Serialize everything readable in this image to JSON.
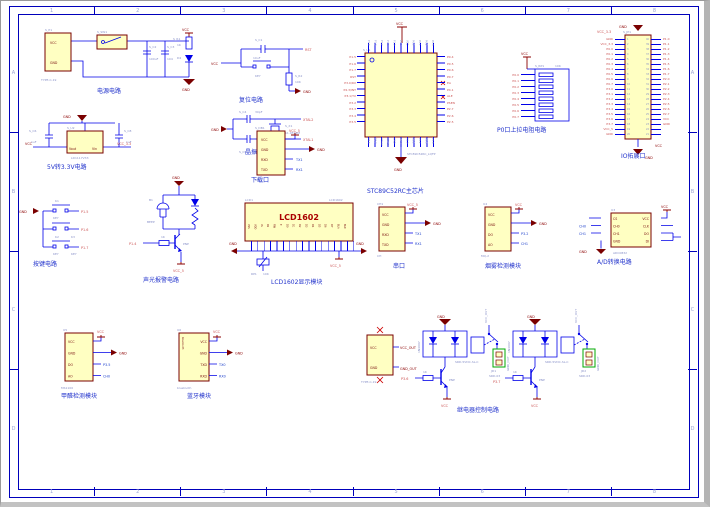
{
  "sheet": {
    "zones_h": [
      "1",
      "2",
      "3",
      "4",
      "5",
      "6",
      "7",
      "8"
    ],
    "zones_v": [
      "A",
      "B",
      "C",
      "D"
    ]
  },
  "colors": {
    "wire": "#0000E8",
    "frame": "#0000BB",
    "component_outline": "#7A0000",
    "component_fill": "#FFFFC2",
    "net_red": "#CC5555",
    "power_red": "#8B0000",
    "designator_blue": "#8890C8",
    "caption_blue": "#2233CC",
    "terminal_green": "#00AA00"
  },
  "blocks": {
    "power": {
      "label": "电源电路",
      "designator": "S_P1",
      "part": "TYPE-C-19",
      "pin1": "VCC",
      "pin2": "GND",
      "switch_des": "S_SW1",
      "cap1_des": "S_C2",
      "cap1_val": "100uF",
      "cap2_des": "S_C3",
      "cap2_val": "104",
      "res_des": "S_R1",
      "res_val": "1K",
      "led_des": "D4",
      "net_vcc": "VCC",
      "net_gnd": "GND"
    },
    "reset": {
      "label": "复位电路",
      "cap_des": "S_C1",
      "cap_val": "10uF",
      "key_part": "KEY",
      "res_des": "S_R2",
      "res_val": "10K",
      "net_vcc": "VCC",
      "net_rst": "RST",
      "net_gnd": "GND"
    },
    "crystal": {
      "label": "晶振电路",
      "cap1_des": "S_C4",
      "cap1_val": "30pF",
      "cap2_des": "S_C5",
      "cap2_val": "30pF",
      "xtal_des": "S_X1",
      "xtal_val": "11.0592M",
      "net_gnd": "GND",
      "net_xtal2": "XTAL2",
      "net_xtal1": "XTAL1"
    },
    "chip": {
      "label": "STC89C52RC主芯片",
      "designator": "S_U1",
      "part": "STC89C52RC_LQFP",
      "net_vcc": "VCC",
      "net_gnd": "GND",
      "left_pins": [
        "P1.5",
        "P1.6",
        "P1.7",
        "RST",
        "P3.0/RX",
        "P4.3/INT",
        "P3.1/TX",
        "P3.2",
        "P3.3",
        "P3.4",
        "P3.5"
      ],
      "right_pins": [
        "P0.4",
        "P0.5",
        "P0.6",
        "P0.7",
        "EA",
        "P4.1",
        "ALE",
        "PSEN",
        "P2.7",
        "P2.6",
        "P2.5"
      ],
      "top_pins": [
        "P1.4",
        "P1.3",
        "P1.2",
        "P1.1",
        "P1.0",
        "P4.2",
        "VCC",
        "P0.0",
        "P0.1",
        "P0.2",
        "P0.3"
      ],
      "bottom_pins": [
        "P3.6",
        "P3.7",
        "XTAL2",
        "XTAL1",
        "GND",
        "P4.0",
        "P2.0",
        "P2.1",
        "P2.2",
        "P2.3",
        "P2.4"
      ]
    },
    "pullup": {
      "label": "P0口上拉电阻电路",
      "designator": "S_RP1",
      "value": "10K",
      "net_vcc": "VCC",
      "nets": [
        "P0.0",
        "P0.1",
        "P0.2",
        "P0.3",
        "P0.4",
        "P0.5",
        "P0.6",
        "P0.7"
      ]
    },
    "ioport": {
      "label": "IO拓展口",
      "designator": "S_JP1",
      "net_top_gnd": "GND",
      "net_top_vcc": "VCC_3.3",
      "net_bot_vcc": "VCC",
      "net_bot_gnd": "GND",
      "left_nets": [
        "GND",
        "VCC_3.3",
        "P0.0",
        "P0.1",
        "P0.2",
        "P0.3",
        "P0.4",
        "P0.5",
        "P0.6",
        "P0.7",
        "P3.0",
        "P3.1",
        "P3.2",
        "P3.3",
        "P3.4",
        "P3.5",
        "P3.6",
        "P3.7",
        "VCC_5",
        "GND"
      ],
      "right_nets": [
        "P1.0",
        "P1.1",
        "P1.2",
        "P1.3",
        "P1.4",
        "P1.5",
        "P1.6",
        "P1.7",
        "P2.0",
        "P2.1",
        "P2.2",
        "P2.3",
        "P2.4",
        "P2.5",
        "P2.6",
        "P2.7",
        "VCC",
        "GND"
      ],
      "nums_left": [
        "1",
        "2",
        "3",
        "4",
        "5",
        "6",
        "7",
        "8",
        "9",
        "10",
        "11",
        "12",
        "13",
        "14",
        "15",
        "16",
        "17",
        "18",
        "19",
        "20"
      ],
      "nums_right": [
        "40",
        "39",
        "38",
        "37",
        "36",
        "35",
        "34",
        "33",
        "32",
        "31",
        "30",
        "29",
        "28",
        "27",
        "26",
        "25",
        "24",
        "23",
        "22",
        "21"
      ]
    },
    "reg33": {
      "label": "5V转3.3V电路",
      "designator": "S_U2",
      "part": "LD1117V33",
      "pin_out": "Vout",
      "pin_in": "Vin",
      "cap1_des": "S_C6",
      "cap1_val": "1uF",
      "cap2_des": "S_C8",
      "cap2_val": "1uF",
      "net_vcc": "VCC",
      "net_33": "VCC_3.3",
      "net_gnd": "GND"
    },
    "download": {
      "label": "下载口",
      "designator": "S_DB1",
      "part": "XH",
      "pins": [
        "VCC",
        "GND",
        "RXD",
        "TXD"
      ],
      "nets": [
        "VCC_5",
        "GND",
        "TX1",
        "RX1"
      ]
    },
    "keys": {
      "label": "按键电路",
      "net_gnd": "GND",
      "items": [
        {
          "des": "K1",
          "part": "KEY",
          "net": "P1.5"
        },
        {
          "des": "K2",
          "part": "KEY",
          "net": "P1.6"
        },
        {
          "des": "K3",
          "part": "KEY",
          "net": "P1.7"
        }
      ]
    },
    "alarm": {
      "label": "声光报警电路",
      "net_gnd": "GND",
      "buzzer_des": "B1",
      "buzzer_part": "BEEP",
      "trans_part": "PNP",
      "res_val": "1K",
      "net_in": "P1.4",
      "net_vcc": "VCC_5"
    },
    "lcd": {
      "label": "LCD1602显示模块",
      "designator": "LCD1",
      "part": "LCD1602",
      "title": "LCD1602",
      "pins": [
        "VSS",
        "VDD",
        "VL",
        "RS",
        "RW",
        "E",
        "D0",
        "D1",
        "D2",
        "D3",
        "D4",
        "D5",
        "D6",
        "D7",
        "BLA",
        "BLK"
      ],
      "pot_des": "RP1",
      "pot_val": "10K",
      "net_gnd_l": "GND",
      "net_gnd_r": "GND",
      "net_vcc": "VCC_5"
    },
    "serial": {
      "label": "串口",
      "designator": "CH1",
      "part": "CH",
      "pins": [
        "VCC",
        "GND",
        "RXD",
        "TXD"
      ],
      "nets": [
        "VCC_5",
        "GND",
        "TX1",
        "RX1"
      ]
    },
    "smoke": {
      "label": "烟雾检测模块",
      "designator": "U4",
      "part": "MQ-2",
      "pins": [
        "VCC",
        "GND",
        "DO",
        "AO"
      ],
      "nets": [
        "VCC",
        "GND",
        "P3.2",
        "CH1"
      ]
    },
    "adc": {
      "label": "A/D转换电路",
      "designator": "U3",
      "part": "ADC0832",
      "left_pins": [
        "CS",
        "CH0",
        "CH1",
        "GND"
      ],
      "right_pins": [
        "VCC",
        "CLK",
        "DO",
        "DI"
      ],
      "net_vcc": "VCC",
      "net_gnd": "GND",
      "net_ch0": "CH0",
      "net_ch1": "CH1"
    },
    "hcho": {
      "label": "甲醛检测模块",
      "designator": "U5",
      "part": "MS1100",
      "pins": [
        "VCC",
        "GND",
        "DO",
        "AO"
      ],
      "nets": [
        "VCC",
        "GND",
        "P3.5",
        "CH0"
      ]
    },
    "bt": {
      "label": "蓝牙模块",
      "designator": "U6",
      "part": "bluetooth",
      "side_text": "bluetooth",
      "pins": [
        "VCC",
        "GND",
        "TXD",
        "RXD"
      ],
      "nets": [
        "VCC",
        "GND",
        "TX0",
        "RX0"
      ]
    },
    "relay": {
      "label": "继电器控制电路",
      "conn_part": "TYPE-C-19",
      "conn_pins": [
        "VCC",
        "GND"
      ],
      "conn_nets": [
        "VCC_OUT",
        "GND_OUT"
      ],
      "net_gnd": "GND",
      "net_vcc": "VCC",
      "vcc_out": "VCC_OUT",
      "gnd_out": "GND_OUT",
      "units": [
        {
          "diode": "1N4007",
          "relay_part": "SRD-5VDC-SL-C",
          "trans": "PNP",
          "res": "1K",
          "net_in": "P3.6",
          "term_des": "JD1",
          "term_part": "SRD-03"
        },
        {
          "diode": "1N4007",
          "relay_part": "SRD-5VDC-SL-C",
          "trans": "PNP",
          "res": "1K",
          "net_in": "P3.7",
          "term_des": "JD2",
          "term_part": "SRD-03"
        }
      ]
    }
  }
}
